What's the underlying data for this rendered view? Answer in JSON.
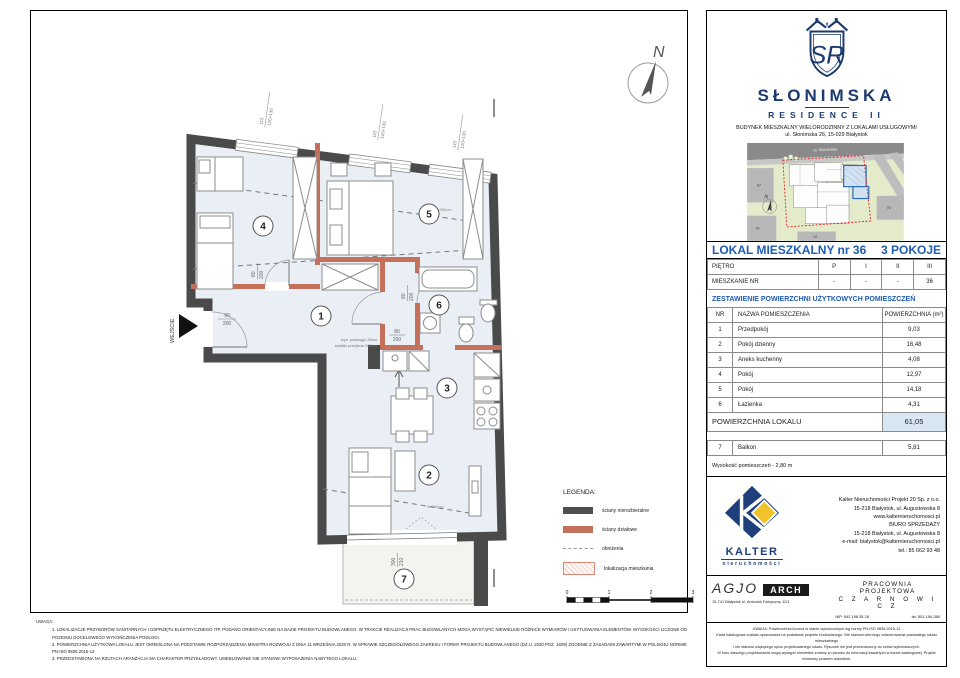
{
  "colors": {
    "brand_navy": "#1c3a6e",
    "heading_blue": "#1f5cb5",
    "wall_dark": "#4a4a4a",
    "partition_red": "#c4705a",
    "room_fill": "#e9eff5",
    "total_row_bg": "#d9e7f4",
    "site_boundary_red": "#e02828",
    "unit_highlight_blue": "#2b6cb8",
    "kalter_yellow": "#f0c32a"
  },
  "plan": {
    "north": "N",
    "entrance": "WEJŚCIE",
    "rooms": [
      "1",
      "2",
      "3",
      "4",
      "5",
      "6",
      "7"
    ],
    "win_num": "115",
    "win_size": "120+130",
    "door_entrance": [
      "90",
      "200"
    ],
    "door": [
      "80",
      "200"
    ],
    "balcony": [
      "300",
      "210"
    ],
    "beam_note": [
      "wys. podciągu 28cm",
      "światło przejścia 260cm"
    ],
    "h_note": "h=260cm",
    "legend": {
      "title": "LEGENDA:",
      "items": [
        "ściany nierozbieralne",
        "ściany działowe",
        "obniżenia",
        "lokalizacja mieszkania"
      ],
      "scale": [
        "0",
        "1",
        "2",
        "3"
      ]
    }
  },
  "uwaga": {
    "title": "UWAGA:",
    "items": [
      "1.    LOKALIZACJE PRZYBORÓW SANITARNYCH I OSPRZĘTU ELEKTRYCZNEGO ITP. PODANO ORIENTACYJNIE NA BAZIE PROJEKTU BUDOWLANEGO. W TRAKCIE REALIZACJI PRAC BUDOWLANYCH MOGĄ WYSTĄPIĆ NIEWIELKIE RÓŻNICE WYMIARÓW I USYTUOWANIA ELEMENTÓW. WYSOKOŚCI LICZONE OD POZIOMU DOCELOWEGO WYKOŃCZENIA PODŁOGI.",
      "2.    POWIERZCHNIA UŻYTKOWA LOKALU JEST OKREŚLONA NA PODSTAWIE ROZPORZĄDZENIA MINISTRA ROZWOJU Z DNIA 11 WRZEŚNIA 2020 R. W SPRAWIE SZCZEGÓŁOWEGO ZAKRESU I FORMY PROJEKTU BUDOWLANEGO (DZ.U. 2020 POZ. 1609) ZGODNIE Z ZASADAMI ZAWARTYMI W POLSKIEJ NORMIE PN-ISO 9836:2015-12",
      "3.    PRZEDSTAWIONA NA RZUTACH ARANŻACJA MA CHARAKTER PRZYKŁADOWY. UMEBLOWANIE NIE STANOWI WYPOSAŻENIA NABYTEGO LOKALU."
    ]
  },
  "panel": {
    "brand": {
      "monogram": "SR",
      "crest_ii": "II",
      "name": "SŁONIMSKA",
      "sub": "RESIDENCE II",
      "line1": "BUDYNEK MIESZKALNY WIELORODZINNY Z LOKALAMI USŁUGOWYMI",
      "line2": "ul. Słonimska 26, 15-029 Białystok"
    },
    "map": {
      "street": "ul. Słonimska",
      "block": "IV",
      "north": "N"
    },
    "unit": {
      "title": "LOKAL MIESZKALNY  nr 36",
      "type": "3 POKOJE"
    },
    "floors": {
      "row1_label": "PIĘTRO",
      "row1": [
        "P",
        "I",
        "II",
        "III"
      ],
      "row2_label": "MIESZKANIE NR",
      "row2": [
        "-",
        "-",
        "-",
        "36"
      ]
    },
    "areas": {
      "heading": "ZESTAWIENIE POWIERZCHNI UŻYTKOWYCH POMIESZCZEŃ",
      "col_nr": "NR",
      "col_name": "NAZWA POMIESZCZENIA",
      "col_area": "POWIERZCHNIA (m²)",
      "rows": [
        [
          "1",
          "Przedpokój",
          "9,03"
        ],
        [
          "2",
          "Pokój dzienny",
          "16,48"
        ],
        [
          "3",
          "Aneks kuchenny",
          "4,08"
        ],
        [
          "4",
          "Pokój",
          "12,97"
        ],
        [
          "5",
          "Pokój",
          "14,18"
        ],
        [
          "6",
          "Łazienka",
          "4,31"
        ]
      ],
      "total_label": "POWIERZCHNIA LOKALU",
      "total_value": "61,05",
      "extra_row": [
        "7",
        "Balkon",
        "5,81"
      ],
      "height_note": "Wysokość pomieszczeń - 2,80 m"
    },
    "kalter": {
      "logo_name": "KALTER",
      "logo_sub": "nieruchomości",
      "lines": [
        "Kalter Nieruchomości Projekt 20  Sp. z o.o.",
        "15-218 Białystok, ul. Augustowska 8",
        "www.kalternieruchomosci.pl",
        "BIURO SPRZEDAŻY",
        "15-218 Białystok, ul. Augustowska 8",
        "e-mail: bialystok@kalternieruchomosci.pl",
        "tel.: 85 662 93 48"
      ]
    },
    "agio": {
      "name": "AGJO",
      "arch": "ARCH",
      "address": "15-741 Białystok    ul. Antoniuk Fabryczny  12/1",
      "studio1": "PRACOWNIA PROJEKTOWA",
      "studio2": "C Z A R N O W I C Z",
      "nip": "NIP:  542 198 35 28",
      "tel": "tel. 501-154-380"
    },
    "disclaimer": [
      "UWAGA:  Powierzchnia liczona w stanie wykończonym wg normy PN-ISO 9836:2015-12",
      "Karta katalogowa została opracowana na podstawie projektu budowlanego.  Nie stanowi wiernego odwzorowania powstałego lokalu mieszkalnego",
      "i nie stanowi wiążącego opisu projektowanego lokalu. Rysunek nie jest przeznaczony do celów wykonawczych.",
      "W toku dalszego projektowania mogą wystąpić niewielkie zmiany w rysunku do informacji zawartych w karcie katalogowej. Projekt chroniony prawem autorskim."
    ]
  }
}
